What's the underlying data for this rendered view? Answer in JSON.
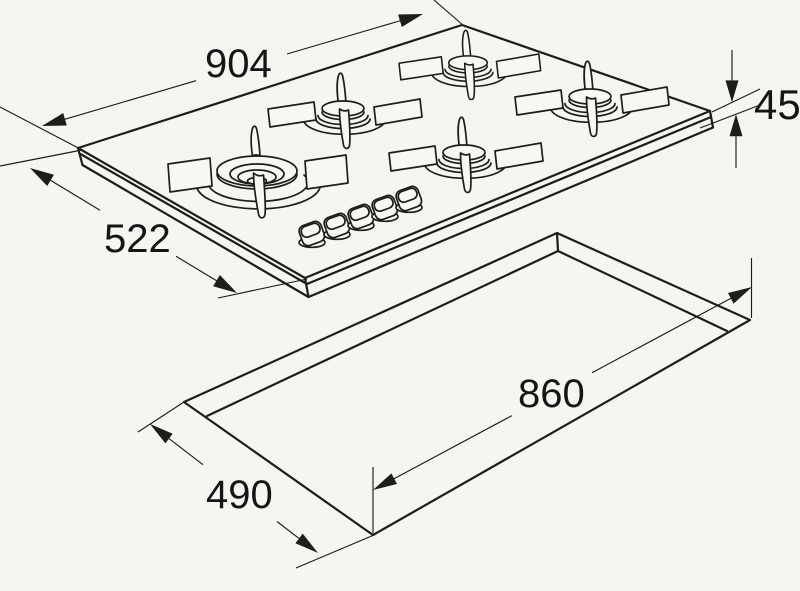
{
  "diagram": {
    "description": "Installation line drawing of a five-burner gas hob with worktop cutout dimensions",
    "dimensions": {
      "hob_width": "904",
      "hob_depth": "522",
      "hob_height": "45",
      "cutout_width": "860",
      "cutout_depth": "490"
    },
    "colors": {
      "line": "#1d1d1b",
      "background": "#f5f6f2",
      "text": "#151515"
    }
  }
}
